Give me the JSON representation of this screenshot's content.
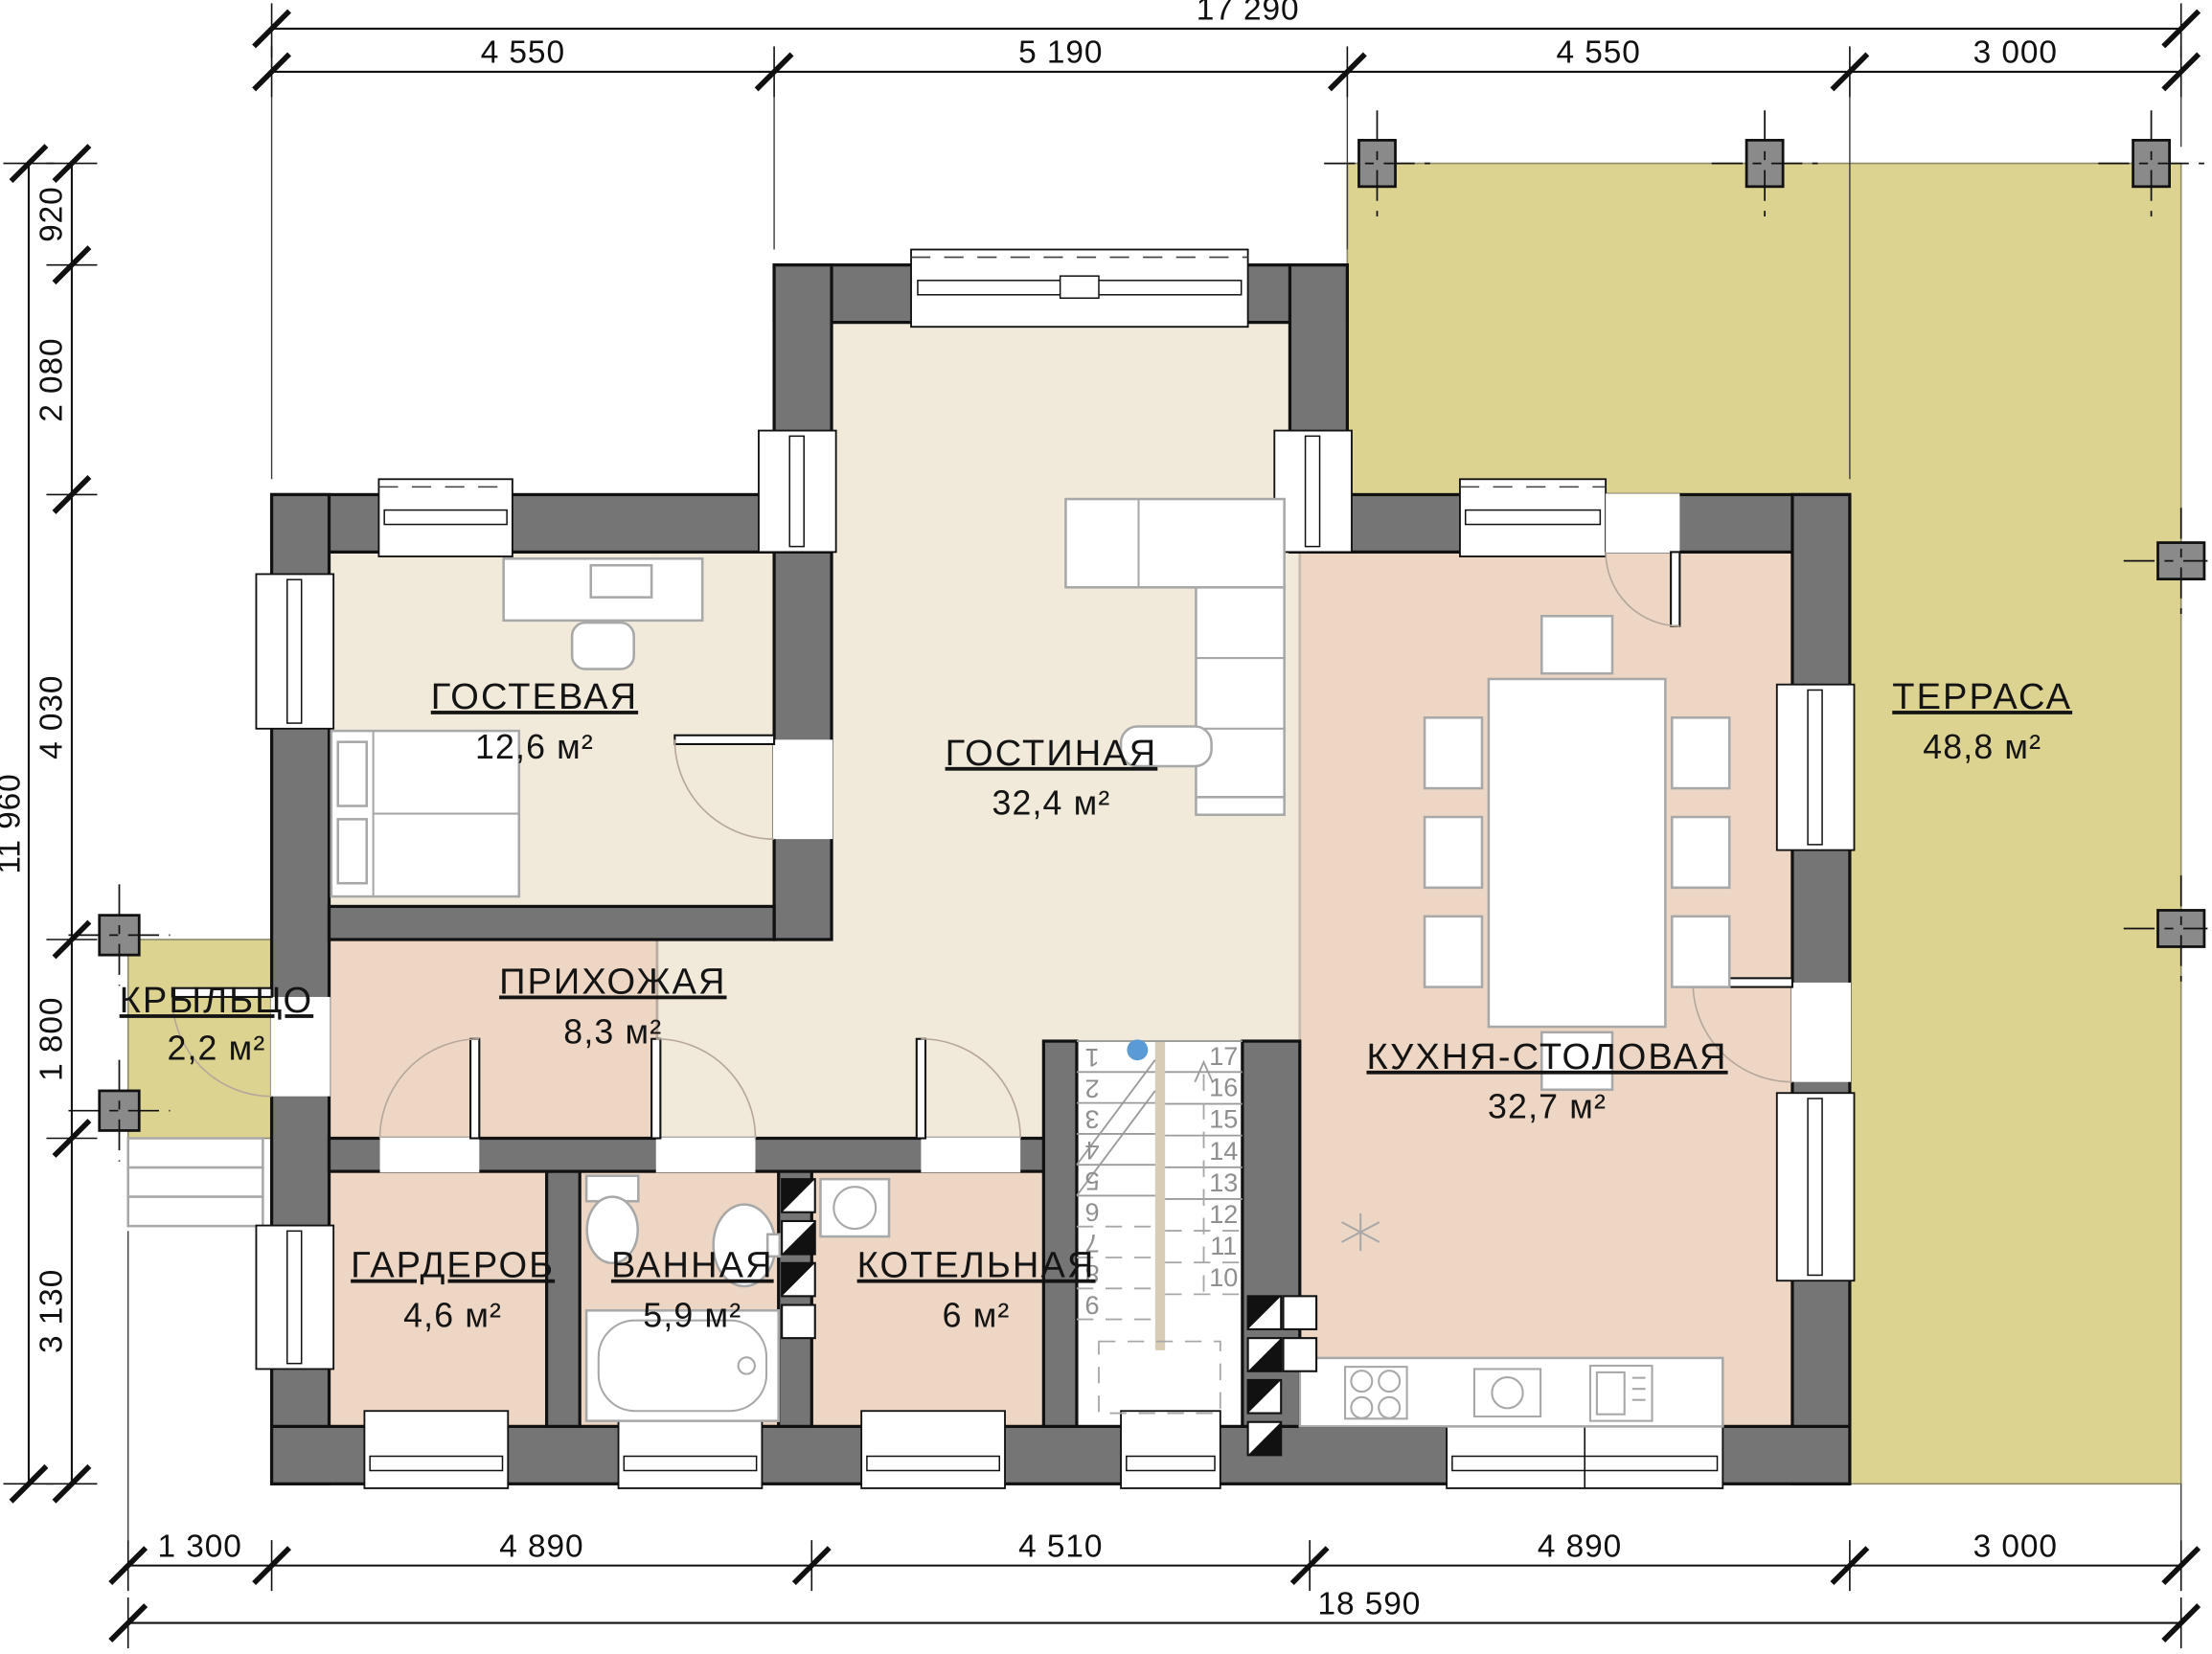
{
  "dimensions": {
    "top_total": "17 290",
    "top_segments": [
      "4 550",
      "5 190",
      "4 550",
      "3 000"
    ],
    "left_total": "11 960",
    "left_segments": [
      "920",
      "2 080",
      "4 030",
      "1 800",
      "3 130"
    ],
    "bottom_segments": [
      "1 300",
      "4 890",
      "4 510",
      "4 890",
      "3 000"
    ],
    "bottom_total": "18 590"
  },
  "rooms": {
    "guest": {
      "name": "ГОСТЕВАЯ",
      "area": "12,6 м²"
    },
    "living": {
      "name": "ГОСТИНАЯ",
      "area": "32,4 м²"
    },
    "kitchen": {
      "name": "КУХНЯ-СТОЛОВАЯ",
      "area": "32,7 м²"
    },
    "terrace": {
      "name": "ТЕРРАСА",
      "area": "48,8 м²"
    },
    "porch": {
      "name": "КРЫЛЬЦО",
      "area": "2,2 м²"
    },
    "hall": {
      "name": "ПРИХОЖАЯ",
      "area": "8,3 м²"
    },
    "wardrobe": {
      "name": "ГАРДЕРОБ",
      "area": "4,6 м²"
    },
    "bath": {
      "name": "ВАННАЯ",
      "area": "5,9 м²"
    },
    "boiler": {
      "name": "КОТЕЛЬНАЯ",
      "area": "6 м²"
    }
  },
  "stairs": {
    "treads": [
      "1",
      "2",
      "3",
      "4",
      "5",
      "6",
      "7",
      "8",
      "9",
      "10",
      "11",
      "12",
      "13",
      "14",
      "15",
      "16",
      "17"
    ]
  },
  "colors": {
    "wall": "#757575",
    "column": "#8a8a8a",
    "room_cream": "#f1e9da",
    "room_pink": "#edd6c4",
    "terrace": "#dcd391",
    "stair_stringer": "#d9ccb4",
    "accent_dot": "#5b9bd5"
  }
}
